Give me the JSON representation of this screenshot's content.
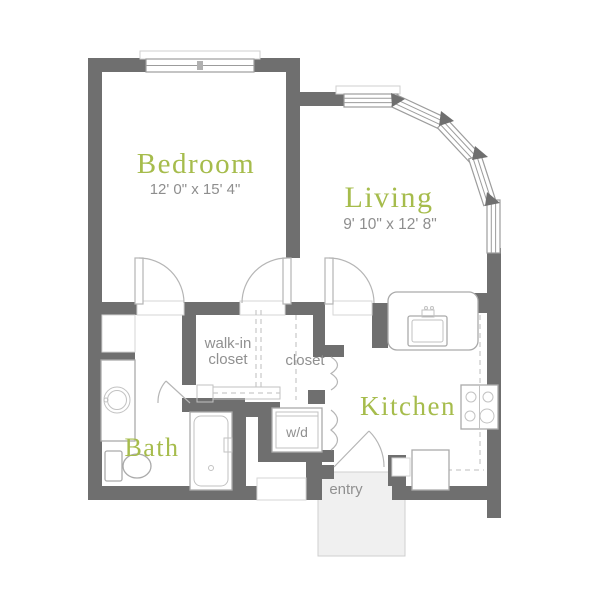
{
  "palette": {
    "wall_color": "#6f6f6f",
    "room_label_color": "#a6bc4c",
    "area_label_color": "#909090",
    "fixture_line_color": "#b5b5b5",
    "entry_fill_color": "#f0f0f0"
  },
  "rooms": {
    "bedroom": {
      "label": "Bedroom",
      "dimensions": "12' 0\" x 15' 4\""
    },
    "living": {
      "label": "Living",
      "dimensions": "9' 10\" x 12' 8\""
    },
    "kitchen": {
      "label": "Kitchen"
    },
    "bath": {
      "label": "Bath"
    }
  },
  "areas": {
    "walk_in_closet": {
      "label_line1": "walk-in",
      "label_line2": "closet"
    },
    "closet": {
      "label": "closet"
    },
    "washer_dryer": {
      "label": "w/d"
    },
    "entry": {
      "label": "entry"
    }
  },
  "fixtures": [
    "bedroom-window",
    "bay-windows",
    "bathroom-sink",
    "toilet",
    "shower",
    "kitchen-sink",
    "stove",
    "refrigerator",
    "washer-dryer-unit",
    "closet-rod"
  ]
}
